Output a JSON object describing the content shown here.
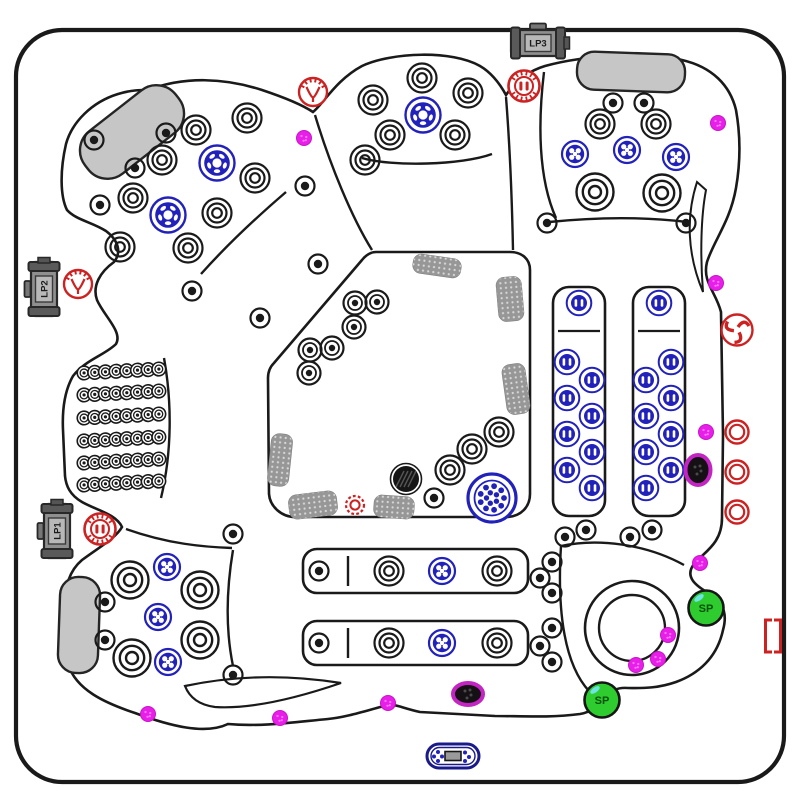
{
  "diagram": {
    "colors": {
      "line": "#1a1a1a",
      "blue": "#2222bb",
      "red": "#cc2222",
      "magenta": "#e81fe8",
      "purple_ring": "#c225c2",
      "green": "#2ecc2e",
      "green_dark": "#04510a",
      "pillow": "#c6c6c6",
      "pad": "#979797",
      "pump_body": "#8f8f8f",
      "pump_cap": "#5a5a5a",
      "pump_plate": "#b8b8b8",
      "navy": "#1a1a8a"
    },
    "pumps": [
      {
        "label": "LP3",
        "x": 538,
        "y": 43,
        "rot": 0
      },
      {
        "label": "LP2",
        "x": 44,
        "y": 289,
        "rot": -90
      },
      {
        "label": "LP1",
        "x": 57,
        "y": 531,
        "rot": -90
      }
    ],
    "speakers": {
      "label": "SP",
      "positions": [
        [
          706,
          608
        ],
        [
          602,
          700
        ]
      ]
    },
    "control_panel": {
      "x": 453,
      "y": 756
    },
    "footwell_circle": {
      "x": 632,
      "y": 628,
      "r_outer": 47,
      "r_inner": 33
    },
    "pillows": [
      {
        "x": 132,
        "y": 132,
        "w": 115,
        "h": 54,
        "rot": -38
      },
      {
        "x": 631,
        "y": 72,
        "w": 108,
        "h": 38,
        "rot": 2
      },
      {
        "x": 79,
        "y": 625,
        "w": 40,
        "h": 96,
        "rot": 2
      }
    ],
    "pads": [
      {
        "x": 437,
        "y": 266,
        "w": 48,
        "h": 19,
        "rot": 8
      },
      {
        "x": 510,
        "y": 299,
        "w": 25,
        "h": 44,
        "rot": -5
      },
      {
        "x": 516,
        "y": 389,
        "w": 23,
        "h": 50,
        "rot": -8
      },
      {
        "x": 280,
        "y": 460,
        "w": 21,
        "h": 52,
        "rot": 6
      },
      {
        "x": 313,
        "y": 505,
        "w": 48,
        "h": 24,
        "rot": -7
      },
      {
        "x": 394,
        "y": 507,
        "w": 40,
        "h": 22,
        "rot": 4
      }
    ],
    "panels": {
      "benches": [
        {
          "x": 303,
          "y": 549,
          "w": 225,
          "h": 44,
          "div_x": 348
        },
        {
          "x": 303,
          "y": 621,
          "w": 225,
          "h": 44,
          "div_x": 348
        }
      ],
      "loungers": [
        {
          "x": 553,
          "y": 287,
          "w": 52,
          "h": 229,
          "div_y": 331
        },
        {
          "x": 633,
          "y": 287,
          "w": 52,
          "h": 229,
          "div_y": 331
        }
      ]
    },
    "therapy": {
      "rows_y": [
        371,
        393,
        416,
        439,
        461,
        483
      ],
      "x0": 84,
      "dx": 10.7,
      "count": 8,
      "row_rot": -3
    },
    "jets": {
      "ring_medium": [
        [
          196,
          130
        ],
        [
          247,
          118
        ],
        [
          162,
          160
        ],
        [
          133,
          198
        ],
        [
          255,
          178
        ],
        [
          217,
          213
        ],
        [
          188,
          248
        ],
        [
          120,
          247
        ],
        [
          373,
          100
        ],
        [
          422,
          78
        ],
        [
          468,
          93
        ],
        [
          390,
          135
        ],
        [
          455,
          135
        ],
        [
          365,
          160
        ],
        [
          600,
          124
        ],
        [
          656,
          124
        ],
        [
          450,
          470
        ],
        [
          472,
          449
        ],
        [
          499,
          432
        ],
        [
          389,
          571
        ],
        [
          497,
          571
        ],
        [
          389,
          643
        ],
        [
          497,
          643
        ]
      ],
      "ring_large": [
        [
          595,
          192
        ],
        [
          662,
          193
        ],
        [
          130,
          580
        ],
        [
          200,
          590
        ],
        [
          132,
          658
        ],
        [
          200,
          640
        ]
      ],
      "dot_small": [
        [
          166,
          133
        ],
        [
          135,
          168
        ],
        [
          94,
          140
        ],
        [
          100,
          205
        ],
        [
          192,
          291
        ],
        [
          305,
          186
        ],
        [
          318,
          264
        ],
        [
          260,
          318
        ],
        [
          613,
          103
        ],
        [
          644,
          103
        ],
        [
          547,
          223
        ],
        [
          686,
          223
        ],
        [
          434,
          498
        ],
        [
          105,
          602
        ],
        [
          105,
          640
        ],
        [
          233,
          534
        ],
        [
          233,
          675
        ],
        [
          319,
          571
        ],
        [
          319,
          643
        ],
        [
          552,
          562
        ],
        [
          540,
          578
        ],
        [
          552,
          593
        ],
        [
          552,
          628
        ],
        [
          540,
          646
        ],
        [
          552,
          662
        ],
        [
          565,
          537
        ],
        [
          586,
          530
        ],
        [
          630,
          537
        ],
        [
          652,
          530
        ]
      ],
      "dot_mid": [
        [
          355,
          303
        ],
        [
          377,
          302
        ],
        [
          354,
          327
        ],
        [
          310,
          350
        ],
        [
          332,
          348
        ],
        [
          309,
          373
        ]
      ],
      "blue_soccer": [
        [
          217,
          163
        ],
        [
          168,
          215
        ],
        [
          423,
          115
        ]
      ],
      "blue_cluster": [
        [
          575,
          154
        ],
        [
          627,
          150
        ],
        [
          676,
          157
        ],
        [
          442,
          571
        ],
        [
          442,
          643
        ],
        [
          167,
          567
        ],
        [
          158,
          617
        ],
        [
          168,
          662
        ]
      ],
      "blue_cluster_large": [
        [
          492,
          498
        ]
      ],
      "blue_slot": [
        [
          579,
          303
        ],
        [
          567,
          362
        ],
        [
          592,
          380
        ],
        [
          567,
          398
        ],
        [
          592,
          416
        ],
        [
          567,
          434
        ],
        [
          592,
          452
        ],
        [
          567,
          470
        ],
        [
          592,
          488
        ],
        [
          659,
          303
        ],
        [
          671,
          362
        ],
        [
          646,
          380
        ],
        [
          671,
          398
        ],
        [
          646,
          416
        ],
        [
          671,
          434
        ],
        [
          646,
          452
        ],
        [
          671,
          470
        ],
        [
          646,
          488
        ]
      ],
      "red_neck": [
        [
          313,
          92
        ],
        [
          78,
          284
        ]
      ],
      "red_rotor": [
        [
          524,
          86
        ],
        [
          100,
          529
        ]
      ],
      "red_tri": [
        [
          737,
          330
        ]
      ],
      "red_ring": [
        [
          737,
          432
        ],
        [
          737,
          472
        ],
        [
          737,
          512
        ]
      ],
      "red_gear": [
        [
          355,
          505
        ]
      ],
      "red_bracket": [
        [
          773,
          636
        ]
      ],
      "drain_black": [
        [
          406,
          479
        ]
      ],
      "drain_purple": [
        {
          "x": 698,
          "y": 470,
          "rx": 12.5,
          "ry": 15
        },
        {
          "x": 468,
          "y": 694,
          "rx": 15,
          "ry": 11
        }
      ],
      "magenta": [
        [
          304,
          138
        ],
        [
          718,
          123
        ],
        [
          716,
          283
        ],
        [
          706,
          432
        ],
        [
          700,
          563
        ],
        [
          668,
          635
        ],
        [
          658,
          659
        ],
        [
          636,
          665
        ],
        [
          388,
          703
        ],
        [
          280,
          718
        ],
        [
          148,
          714
        ]
      ]
    }
  }
}
